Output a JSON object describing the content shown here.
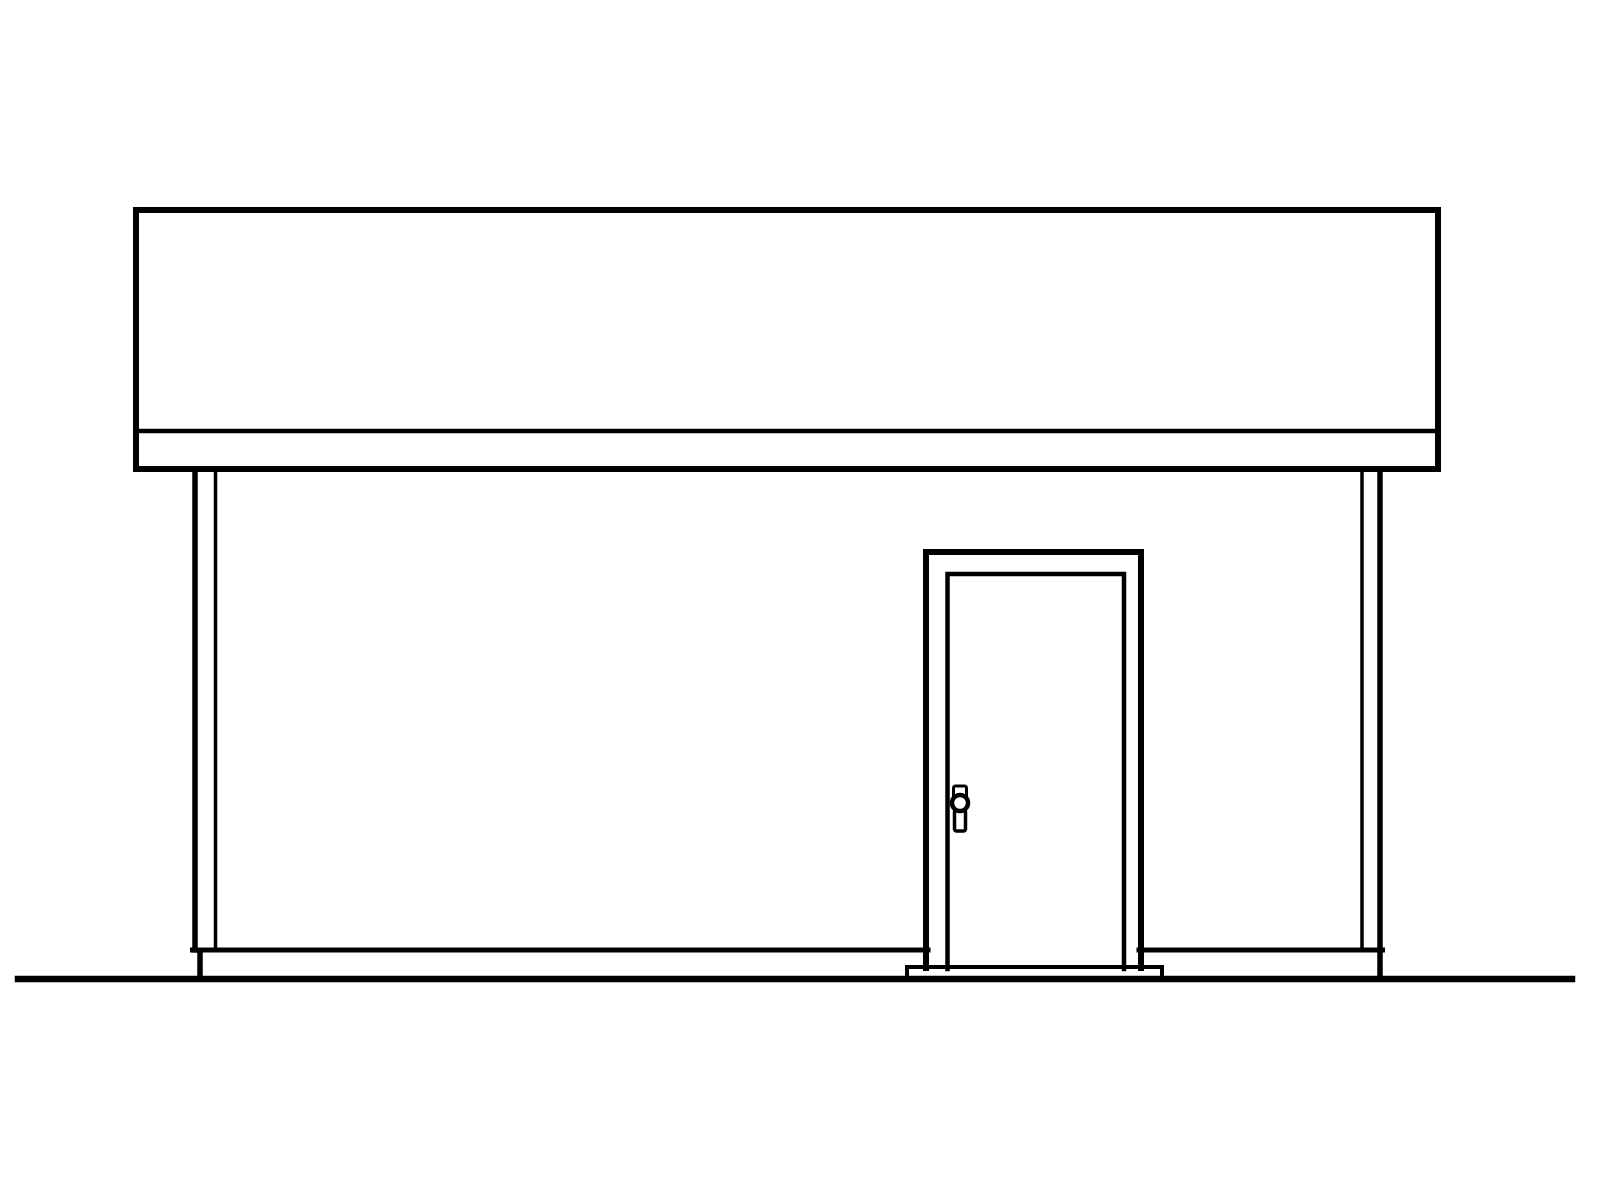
{
  "canvas": {
    "width": 1600,
    "height": 1200,
    "background": "#ffffff",
    "stroke_color": "#000000"
  },
  "drawing": {
    "type": "architectural-elevation-line-drawing",
    "subject": "building-side-elevation-with-door",
    "elements": [
      {
        "name": "roof-fascia-band",
        "shape": "rect",
        "x": 136,
        "y": 210,
        "w": 1302,
        "h": 259,
        "stroke_width": 6
      },
      {
        "name": "fascia-trim-line",
        "shape": "line",
        "x1": 136,
        "y1": 431,
        "x2": 1438,
        "y2": 431,
        "stroke_width": 4.5
      },
      {
        "name": "left-corner-trim-outer-line",
        "shape": "line",
        "x1": 195,
        "y1": 470,
        "x2": 195,
        "y2": 950,
        "stroke_width": 5.5
      },
      {
        "name": "left-corner-trim-inner-line",
        "shape": "line",
        "x1": 215.5,
        "y1": 470,
        "x2": 215.5,
        "y2": 950,
        "stroke_width": 3.5
      },
      {
        "name": "right-corner-trim-inner-line",
        "shape": "line",
        "x1": 1362,
        "y1": 470,
        "x2": 1362,
        "y2": 950,
        "stroke_width": 3.5
      },
      {
        "name": "right-corner-trim-outer-line",
        "shape": "line",
        "x1": 1380,
        "y1": 470,
        "x2": 1380,
        "y2": 950,
        "stroke_width": 5.5
      },
      {
        "name": "wall-base-line-left",
        "shape": "line",
        "x1": 192.5,
        "y1": 950,
        "x2": 928,
        "y2": 950,
        "stroke_width": 5
      },
      {
        "name": "wall-base-line-right",
        "shape": "line",
        "x1": 1139,
        "y1": 950,
        "x2": 1382.5,
        "y2": 950,
        "stroke_width": 5
      },
      {
        "name": "foundation-stub-left",
        "shape": "line",
        "x1": 200,
        "y1": 951,
        "x2": 200,
        "y2": 978,
        "stroke_width": 5.5
      },
      {
        "name": "foundation-stub-right",
        "shape": "line",
        "x1": 1380,
        "y1": 951,
        "x2": 1380,
        "y2": 978,
        "stroke_width": 5.5
      },
      {
        "name": "door-frame-outline",
        "shape": "polyline",
        "points": [
          [
            926,
            968
          ],
          [
            926,
            552
          ],
          [
            1141,
            552
          ],
          [
            1141,
            968
          ]
        ],
        "stroke_width": 6
      },
      {
        "name": "door-panel-outline",
        "shape": "polyline",
        "points": [
          [
            947.5,
            969
          ],
          [
            947.5,
            574
          ],
          [
            1124,
            574
          ],
          [
            1124,
            969
          ]
        ],
        "stroke_width": 4.5
      },
      {
        "name": "door-threshold",
        "shape": "polyline",
        "points": [
          [
            907,
            978
          ],
          [
            907,
            967
          ],
          [
            1162,
            967
          ],
          [
            1162,
            978
          ]
        ],
        "stroke_width": 4
      },
      {
        "name": "ground-line",
        "shape": "line",
        "x1": 18,
        "y1": 979,
        "x2": 1572,
        "y2": 979,
        "stroke_width": 6.5
      },
      {
        "name": "door-knob-thumb-latch",
        "shape": "rect",
        "x": 953.5,
        "y": 786,
        "w": 13,
        "h": 13,
        "rx": 2,
        "stroke_width": 3
      },
      {
        "name": "door-knob-backplate",
        "shape": "rect",
        "x": 954.5,
        "y": 810,
        "w": 11,
        "h": 21,
        "rx": 2,
        "stroke_width": 3.5
      },
      {
        "name": "door-knob",
        "shape": "circle",
        "cx": 960,
        "cy": 803,
        "r": 8,
        "stroke_width": 4.5,
        "fill": "#ffffff"
      }
    ]
  }
}
